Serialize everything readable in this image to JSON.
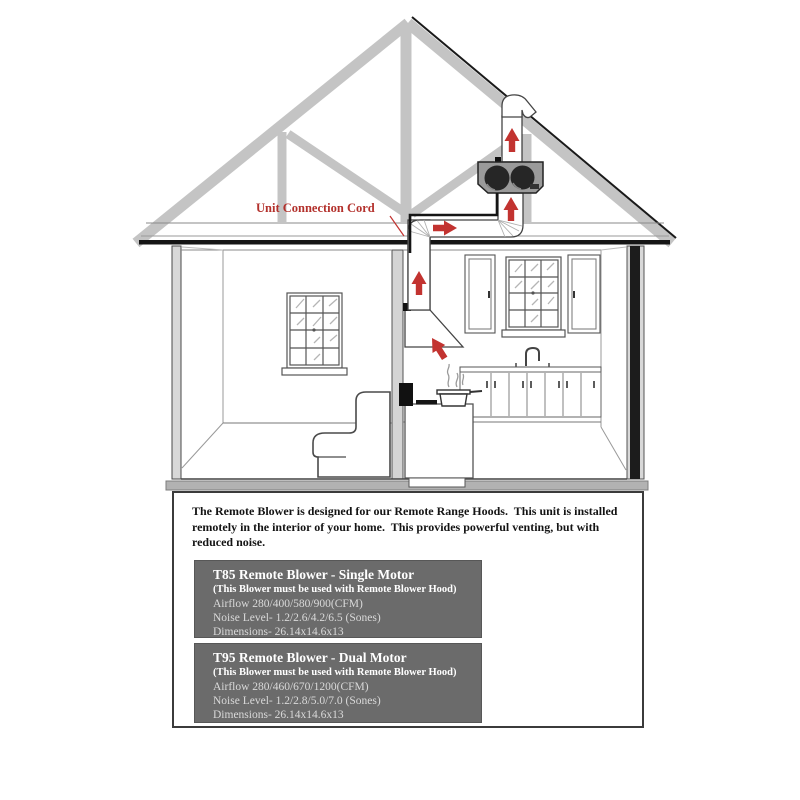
{
  "diagram_label": {
    "unit_connection_cord": "Unit Connection Cord"
  },
  "description": {
    "line1": "The Remote Blower is designed for our Remote Range Hoods.  This unit is installed",
    "line2": "remotely in the interior of your home.  This provides powerful venting, but with",
    "line3": "reduced noise."
  },
  "products": [
    {
      "title": "T85 Remote Blower - Single Motor",
      "requirement": "(This Blower must be used with Remote Blower Hood)",
      "airflow": "Airflow 280/400/580/900(CFM)",
      "noise_level": "Noise Level- 1.2/2.6/4.2/6.5 (Sones)",
      "dimensions": "Dimensions- 26.14x14.6x13"
    },
    {
      "title": "T95 Remote Blower - Dual Motor",
      "requirement": "(This Blower must be used with Remote Blower Hood)",
      "airflow": "Airflow 280/460/670/1200(CFM)",
      "noise_level": "Noise Level- 1.2/2.8/5.0/7.0 (Sones)",
      "dimensions": "Dimensions- 26.14x14.6x13"
    }
  ],
  "colors": {
    "airflow_arrow_red": "#c23330",
    "label_red": "#b3312c",
    "info_box_background": "#6b6b6b",
    "info_box_data_text": "#d9d9d9",
    "truss_gray": "#c4c4c4"
  }
}
